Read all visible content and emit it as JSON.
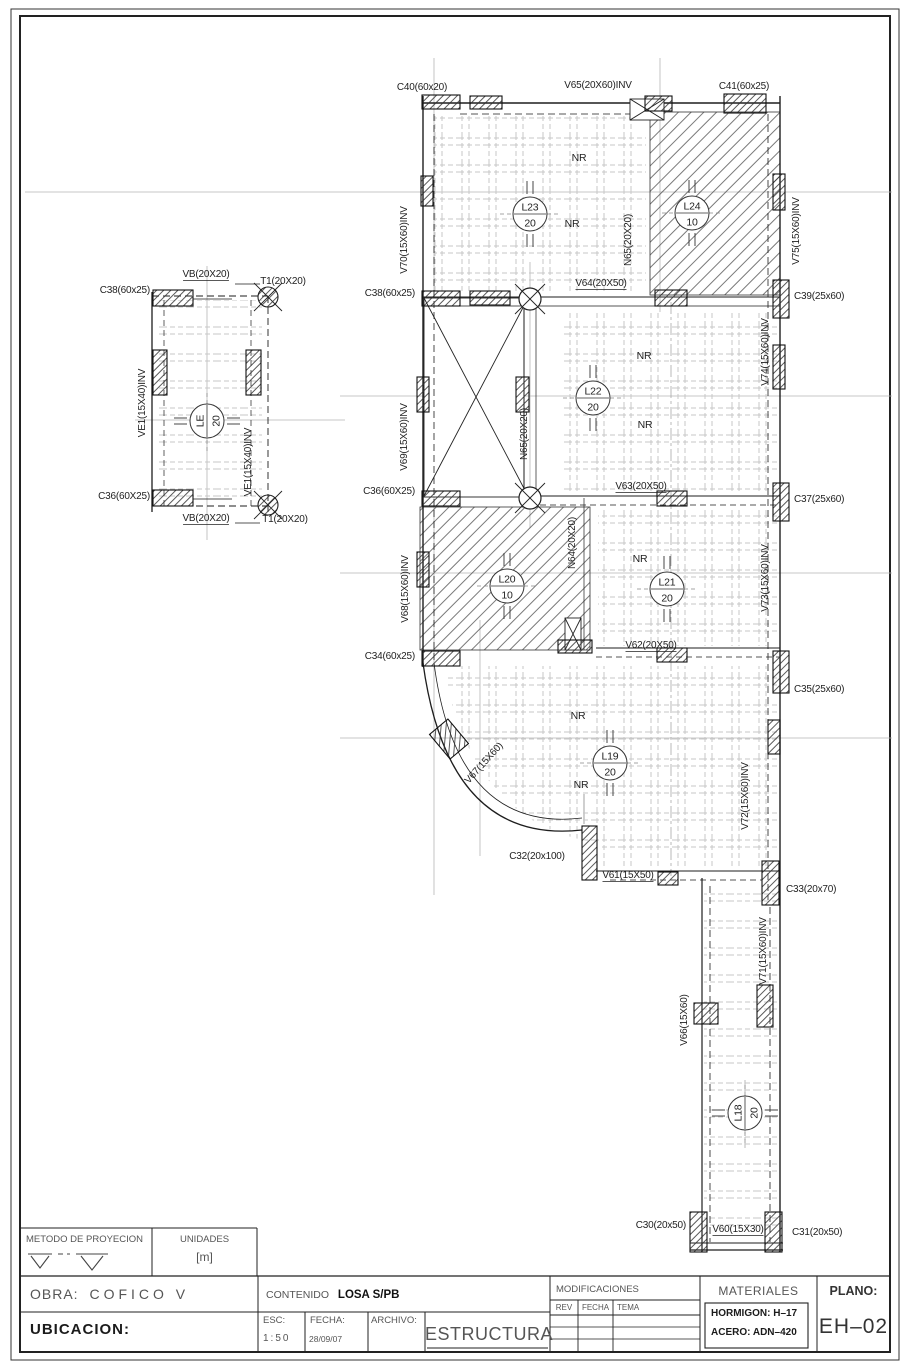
{
  "sheet": {
    "bg": "#ffffff",
    "line_color": "#1f1f1f",
    "construction_color": "#b5b5b5",
    "rib_color": "#c7c7c7"
  },
  "plan": {
    "labels": [
      {
        "t": "C38(60x25)",
        "x": 150,
        "y": 293,
        "a": "end"
      },
      {
        "t": "VB(20X20)",
        "x": 206,
        "y": 277,
        "ul": 1
      },
      {
        "t": "T1(20X20)",
        "x": 283,
        "y": 284
      },
      {
        "t": "VE1(15X40)INV",
        "x": 145,
        "y": 403,
        "r": -90
      },
      {
        "t": "VE1(15X40)INV",
        "x": 251,
        "y": 462,
        "r": -90
      },
      {
        "t": "C36(60X25)",
        "x": 150,
        "y": 499,
        "a": "end"
      },
      {
        "t": "VB(20X20)",
        "x": 206,
        "y": 521,
        "ul": 1
      },
      {
        "t": "T1(20X20)",
        "x": 285,
        "y": 522
      },
      {
        "t": "C40(60x20)",
        "x": 422,
        "y": 90
      },
      {
        "t": "V65(20X60)INV",
        "x": 598,
        "y": 88
      },
      {
        "t": "C41(60x25)",
        "x": 744,
        "y": 89
      },
      {
        "t": "V70(15X60)INV",
        "x": 407,
        "y": 240,
        "r": -90
      },
      {
        "t": "N65(20X20)",
        "x": 631,
        "y": 240,
        "r": -90
      },
      {
        "t": "V75(15X60)INV",
        "x": 799,
        "y": 231,
        "r": -90
      },
      {
        "t": "NR",
        "x": 579,
        "y": 161,
        "s": 10.5
      },
      {
        "t": "NR",
        "x": 572,
        "y": 227,
        "s": 10.5
      },
      {
        "t": "C38(60x25)",
        "x": 415,
        "y": 296,
        "a": "end"
      },
      {
        "t": "V64(20X50)",
        "x": 601,
        "y": 286,
        "ul": 1
      },
      {
        "t": "C39(25x60)",
        "x": 794,
        "y": 299,
        "a": "start"
      },
      {
        "t": "V69(15X60)INV",
        "x": 407,
        "y": 437,
        "r": -90
      },
      {
        "t": "N65(20X20)",
        "x": 527,
        "y": 434,
        "r": -90
      },
      {
        "t": "V74(15X60)INV",
        "x": 768,
        "y": 352,
        "r": -90
      },
      {
        "t": "NR",
        "x": 644,
        "y": 359,
        "s": 10.5
      },
      {
        "t": "NR",
        "x": 645,
        "y": 428,
        "s": 10.5
      },
      {
        "t": "C36(60X25)",
        "x": 415,
        "y": 494,
        "a": "end"
      },
      {
        "t": "V63(20X50)",
        "x": 641,
        "y": 489,
        "ul": 1
      },
      {
        "t": "C37(25x60)",
        "x": 794,
        "y": 502,
        "a": "start"
      },
      {
        "t": "V68(15X60)INV",
        "x": 408,
        "y": 589,
        "r": -90
      },
      {
        "t": "N64(20X20)",
        "x": 575,
        "y": 543,
        "r": -90
      },
      {
        "t": "V73(15X60)INV",
        "x": 768,
        "y": 578,
        "r": -90
      },
      {
        "t": "NR",
        "x": 640,
        "y": 562,
        "s": 10.5
      },
      {
        "t": "C34(60x25)",
        "x": 415,
        "y": 659,
        "a": "end"
      },
      {
        "t": "V62(20X50)",
        "x": 651,
        "y": 648,
        "ul": 1
      },
      {
        "t": "C35(25x60)",
        "x": 794,
        "y": 692,
        "a": "start"
      },
      {
        "t": "NR",
        "x": 578,
        "y": 719,
        "s": 10.5
      },
      {
        "t": "V67(15X60)",
        "x": 486,
        "y": 765,
        "r": -48
      },
      {
        "t": "NR",
        "x": 581,
        "y": 788,
        "s": 10.5
      },
      {
        "t": "C32(20x100)",
        "x": 537,
        "y": 859
      },
      {
        "t": "V61(15X50)",
        "x": 628,
        "y": 878,
        "ul": 1
      },
      {
        "t": "C33(20x70)",
        "x": 786,
        "y": 892,
        "a": "start"
      },
      {
        "t": "V72(15X60)INV",
        "x": 748,
        "y": 796,
        "r": -90
      },
      {
        "t": "V71(15X60)INV",
        "x": 766,
        "y": 951,
        "r": -90
      },
      {
        "t": "V66(15X60)",
        "x": 687,
        "y": 1020,
        "r": -90
      },
      {
        "t": "C30(20x50)",
        "x": 686,
        "y": 1228,
        "a": "end"
      },
      {
        "t": "V60(15X30)",
        "x": 738,
        "y": 1232,
        "ul": 1
      },
      {
        "t": "C31(20x50)",
        "x": 792,
        "y": 1235,
        "a": "start"
      }
    ],
    "slab_circles": [
      {
        "id": "L23",
        "v": "20",
        "x": 530,
        "y": 214
      },
      {
        "id": "L24",
        "v": "10",
        "x": 692,
        "y": 213
      },
      {
        "id": "L22",
        "v": "20",
        "x": 593,
        "y": 398
      },
      {
        "id": "L20",
        "v": "10",
        "x": 507,
        "y": 586
      },
      {
        "id": "L21",
        "v": "20",
        "x": 667,
        "y": 589
      },
      {
        "id": "L19",
        "v": "20",
        "x": 610,
        "y": 763
      },
      {
        "id": "L18",
        "v": "20",
        "x": 745,
        "y": 1113,
        "r": -90
      },
      {
        "id": "LE",
        "v": "20",
        "x": 207,
        "y": 421,
        "r": -90
      }
    ]
  },
  "titleblock": {
    "metodo": "METODO DE PROYECION",
    "unidades_label": "UNIDADES",
    "unidades_value": "[m]",
    "obra_label": "OBRA:",
    "obra_value": "COFICO  V",
    "ubicacion_label": "UBICACION:",
    "contenido_label": "CONTENIDO",
    "contenido_value": "LOSA  S/PB",
    "esc_label": "ESC:",
    "esc_value": "1:50",
    "fecha_label": "FECHA:",
    "fecha_value": "28/09/07",
    "archivo_label": "ARCHIVO:",
    "archivo_value": "ESTRUCTURA",
    "modificaciones_label": "MODIFICACIONES",
    "rev_label": "REV",
    "mod_fecha_label": "FECHA",
    "tema_label": "TEMA",
    "materiales_label": "MATERIALES",
    "hormigon_value": "HORMIGON:  H–17",
    "acero_value": "ACERO: ADN–420",
    "plano_label": "PLANO:",
    "plano_value": "EH–02"
  }
}
